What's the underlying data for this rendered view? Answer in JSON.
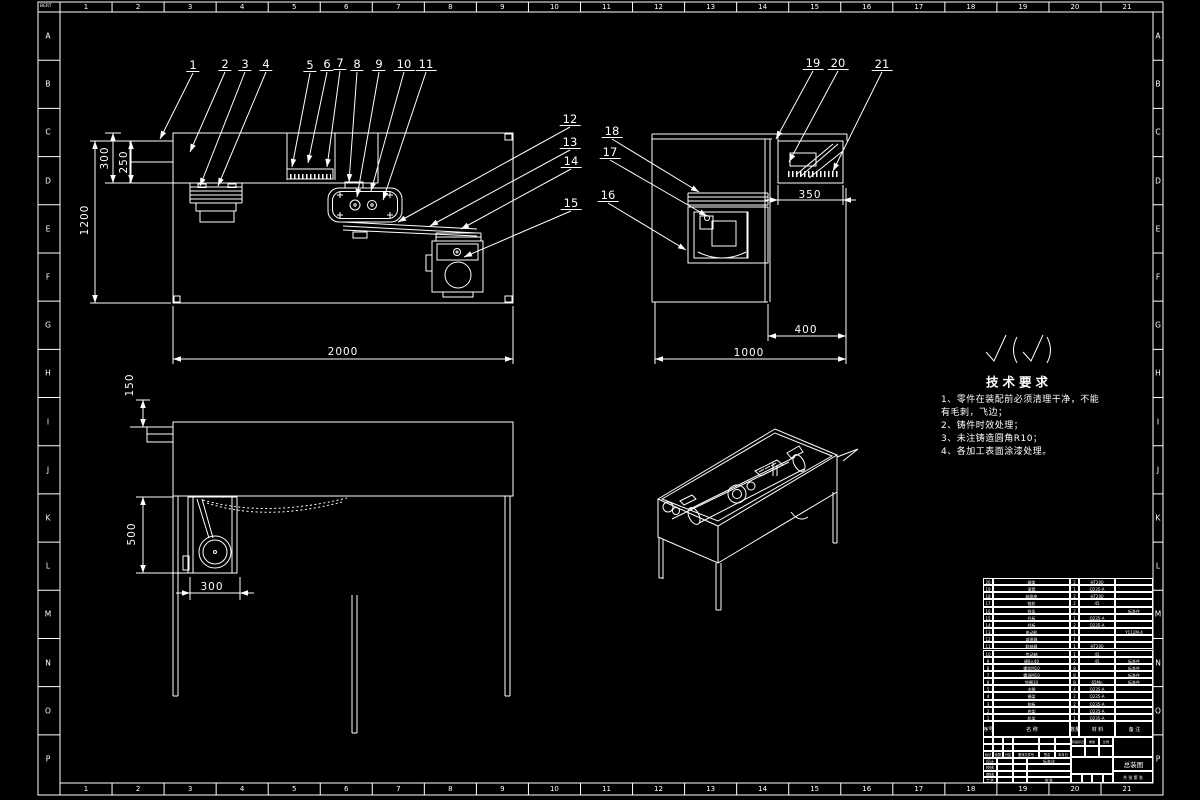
{
  "sheet": {
    "corner_mark": "BERT",
    "zone_letters": [
      "A",
      "B",
      "C",
      "D",
      "E",
      "F",
      "G",
      "H",
      "I",
      "J",
      "K",
      "L",
      "M",
      "N",
      "O",
      "P"
    ],
    "zone_numbers": [
      "1",
      "2",
      "3",
      "4",
      "5",
      "6",
      "7",
      "8",
      "9",
      "10",
      "11",
      "12",
      "13",
      "14",
      "15",
      "16",
      "17",
      "18",
      "19",
      "20",
      "21"
    ]
  },
  "callouts": [
    {
      "n": "1",
      "x": 193,
      "y": 66,
      "tx": 160,
      "ty": 139
    },
    {
      "n": "2",
      "x": 225,
      "y": 65,
      "tx": 190,
      "ty": 152
    },
    {
      "n": "3",
      "x": 245,
      "y": 65,
      "tx": 200,
      "ty": 186
    },
    {
      "n": "4",
      "x": 266,
      "y": 65,
      "tx": 218,
      "ty": 186
    },
    {
      "n": "5",
      "x": 310,
      "y": 66,
      "tx": 292,
      "ty": 167
    },
    {
      "n": "6",
      "x": 327,
      "y": 65,
      "tx": 308,
      "ty": 163
    },
    {
      "n": "7",
      "x": 340,
      "y": 64,
      "tx": 327,
      "ty": 167
    },
    {
      "n": "8",
      "x": 357,
      "y": 65,
      "tx": 349,
      "ty": 182
    },
    {
      "n": "9",
      "x": 379,
      "y": 65,
      "tx": 357,
      "ty": 197
    },
    {
      "n": "10",
      "x": 404,
      "y": 65,
      "tx": 371,
      "ty": 191
    },
    {
      "n": "11",
      "x": 426,
      "y": 65,
      "tx": 383,
      "ty": 200
    },
    {
      "n": "12",
      "x": 570,
      "y": 120,
      "tx": 398,
      "ty": 222
    },
    {
      "n": "13",
      "x": 570,
      "y": 143,
      "tx": 430,
      "ty": 226
    },
    {
      "n": "14",
      "x": 571,
      "y": 162,
      "tx": 461,
      "ty": 229
    },
    {
      "n": "15",
      "x": 571,
      "y": 204,
      "tx": 464,
      "ty": 257
    },
    {
      "n": "16",
      "x": 608,
      "y": 196,
      "tx": 686,
      "ty": 250
    },
    {
      "n": "17",
      "x": 610,
      "y": 153,
      "tx": 707,
      "ty": 216
    },
    {
      "n": "18",
      "x": 612,
      "y": 132,
      "tx": 699,
      "ty": 192
    },
    {
      "n": "19",
      "x": 813,
      "y": 64,
      "tx": 776,
      "ty": 139
    },
    {
      "n": "20",
      "x": 838,
      "y": 64,
      "tx": 789,
      "ty": 162
    },
    {
      "n": "21",
      "x": 882,
      "y": 65,
      "tx": 833,
      "ty": 171
    }
  ],
  "dimensions": [
    {
      "t": "2000",
      "x": 343,
      "y": 352,
      "r": 0
    },
    {
      "t": "1200",
      "x": 85,
      "y": 220,
      "r": 1
    },
    {
      "t": "300",
      "x": 105,
      "y": 158,
      "r": 1
    },
    {
      "t": "250",
      "x": 124,
      "y": 162,
      "r": 1
    },
    {
      "t": "350",
      "x": 810,
      "y": 195,
      "r": 0
    },
    {
      "t": "400",
      "x": 806,
      "y": 330,
      "r": 0
    },
    {
      "t": "1000",
      "x": 749,
      "y": 353,
      "r": 0
    },
    {
      "t": "150",
      "x": 130,
      "y": 385,
      "r": 1
    },
    {
      "t": "500",
      "x": 132,
      "y": 534,
      "r": 1
    },
    {
      "t": "300",
      "x": 212,
      "y": 587,
      "r": 0
    }
  ],
  "tech_requirements": {
    "title": "技术要求",
    "lines": [
      "1、零件在装配前必须清理干净，不能",
      "有毛刺，飞边；",
      "2、铸件时效处理；",
      "3、未注铸造圆角R10；",
      "4、各加工表面涂漆处理。"
    ]
  },
  "parts_list": {
    "headers": [
      "序号",
      "名  称",
      "数量",
      "材  料",
      "备  注"
    ],
    "rows": [
      {
        "no": "20",
        "name": "端盖",
        "qty": "2",
        "mat": "HT200",
        "rem": ""
      },
      {
        "no": "19",
        "name": "滚筒",
        "qty": "1",
        "mat": "Q235-A",
        "rem": ""
      },
      {
        "no": "18",
        "name": "轴承座",
        "qty": "2",
        "mat": "HT200",
        "rem": ""
      },
      {
        "no": "17",
        "name": "链轮",
        "qty": "2",
        "mat": "45",
        "rem": ""
      },
      {
        "no": "16",
        "name": "链条",
        "qty": "2",
        "mat": "",
        "rem": "标准件"
      },
      {
        "no": "15",
        "name": "托板",
        "qty": "1",
        "mat": "Q235-A",
        "rem": ""
      },
      {
        "no": "14",
        "name": "挡板",
        "qty": "2",
        "mat": "Q235-A",
        "rem": ""
      },
      {
        "no": "13",
        "name": "电动机",
        "qty": "1",
        "mat": "",
        "rem": "Y112M-4"
      },
      {
        "no": "12",
        "name": "减速器",
        "qty": "1",
        "mat": "",
        "rem": ""
      },
      {
        "no": "11",
        "name": "联轴器",
        "qty": "1",
        "mat": "HT200",
        "rem": ""
      },
      {
        "no": "10",
        "name": "传动轴",
        "qty": "1",
        "mat": "45",
        "rem": ""
      },
      {
        "no": "9",
        "name": "键8×40",
        "qty": "2",
        "mat": "45",
        "rem": "标准件"
      },
      {
        "no": "8",
        "name": "螺栓M10",
        "qty": "8",
        "mat": "",
        "rem": "标准件"
      },
      {
        "no": "7",
        "name": "螺母M10",
        "qty": "8",
        "mat": "",
        "rem": "标准件"
      },
      {
        "no": "6",
        "name": "垫圈10",
        "qty": "8",
        "mat": "65Mn",
        "rem": "标准件"
      },
      {
        "no": "5",
        "name": "支腿",
        "qty": "4",
        "mat": "Q235-A",
        "rem": ""
      },
      {
        "no": "4",
        "name": "横梁",
        "qty": "2",
        "mat": "Q235-A",
        "rem": ""
      },
      {
        "no": "3",
        "name": "侧板",
        "qty": "2",
        "mat": "Q235-A",
        "rem": ""
      },
      {
        "no": "2",
        "name": "底架",
        "qty": "1",
        "mat": "Q235-A",
        "rem": ""
      },
      {
        "no": "1",
        "name": "机架",
        "qty": "1",
        "mat": "Q235-A",
        "rem": ""
      }
    ]
  },
  "title_block": {
    "change_row": [
      "标记",
      "处数",
      "分区",
      "更改文件号",
      "签名",
      "年月日"
    ],
    "sign_rows": [
      [
        "设计",
        "标准化"
      ],
      [
        "校核",
        ""
      ],
      [
        "审核",
        ""
      ],
      [
        "工艺",
        "批准"
      ]
    ],
    "stage_labels": [
      "阶段标记",
      "重量",
      "比例"
    ],
    "sheet_label": "共 张 第 张",
    "title": "总装图"
  }
}
